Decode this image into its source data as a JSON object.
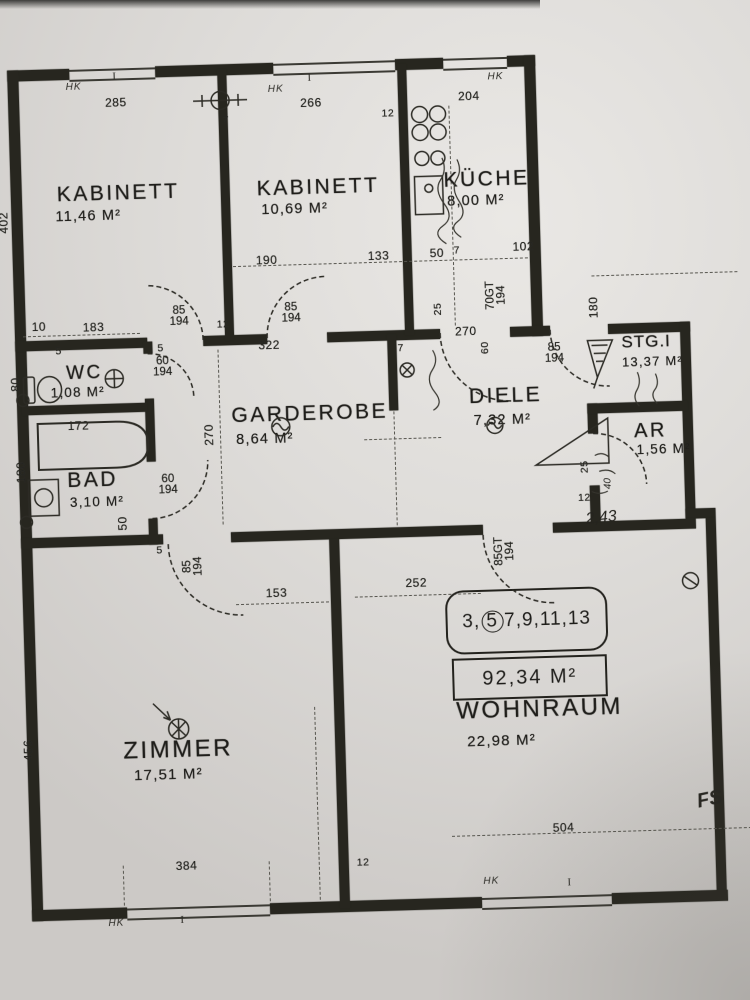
{
  "rooms": {
    "kabinett1": {
      "name": "KABINETT",
      "area": "11,46 M²"
    },
    "kabinett2": {
      "name": "KABINETT",
      "area": "10,69 M²"
    },
    "kueche": {
      "name": "KÜCHE",
      "area": "8,00 M²"
    },
    "wc": {
      "name": "WC",
      "area": "1,08 M²"
    },
    "bad": {
      "name": "BAD",
      "area": "3,10 M²"
    },
    "garderobe": {
      "name": "GARDEROBE",
      "area": "8,64 M²"
    },
    "diele": {
      "name": "DIELE",
      "area": "7,32 M²"
    },
    "stiege": {
      "name": "STG.I",
      "area": "13,37 M²"
    },
    "abstellraum": {
      "name": "AR",
      "area": "1,56 M²"
    },
    "zimmer": {
      "name": "ZIMMER",
      "area": "17,51 M²"
    },
    "wohnraum": {
      "name": "WOHNRAUM",
      "area": "22,98 M²"
    }
  },
  "unit_label": {
    "prefix": "3,",
    "circled": "5",
    "suffix": "7,9,11,13"
  },
  "total_area": "92,34 M²",
  "door_labels": {
    "kabinett1": {
      "w": "85",
      "h": "194"
    },
    "kabinett2": {
      "w": "85",
      "h": "194"
    },
    "wc": {
      "w": "60",
      "h": "194"
    },
    "bad": {
      "w": "60",
      "h": "194"
    },
    "kueche": {
      "w": "70GT",
      "h": "194"
    },
    "stiege": {
      "w": "85",
      "h": "194"
    },
    "zimmer": {
      "w": "85",
      "h": "194"
    },
    "wohnraum": {
      "w": "85GT",
      "h": "194"
    }
  },
  "dimensions": {
    "top_kabinett1": "285",
    "top_kabinett2": "266",
    "top_kueche": "204",
    "wall7_top": "7",
    "wall12_kueche": "12",
    "sill_190": "190",
    "sill_133": "133",
    "sill_50": "50",
    "sill_7": "7",
    "sill_102": "102",
    "row_10": "10",
    "row_183": "183",
    "row_12": "12",
    "row_322": "322",
    "wc_5a": "5",
    "wc_5b": "5",
    "wc_80": "80",
    "bath_172": "172",
    "bad_180": "180",
    "bad_50": "50",
    "left_402": "402",
    "left_456": "456",
    "garderobe_270": "270",
    "diele_270": "270",
    "diele_60": "60",
    "diele_7": "7",
    "kueche_25": "25",
    "stg_180": "180",
    "zimmer_153": "153",
    "zimmer_5": "5",
    "wohnraum_252": "252",
    "bottom_384": "384",
    "bottom_12": "12",
    "bottom_504": "504",
    "ar_25": "25",
    "ar_12": "12"
  },
  "annotations": {
    "hk": "HK",
    "fs": "FS",
    "handwritten_area": "2,43",
    "handwritten_40": "40",
    "window_mark": "I"
  }
}
